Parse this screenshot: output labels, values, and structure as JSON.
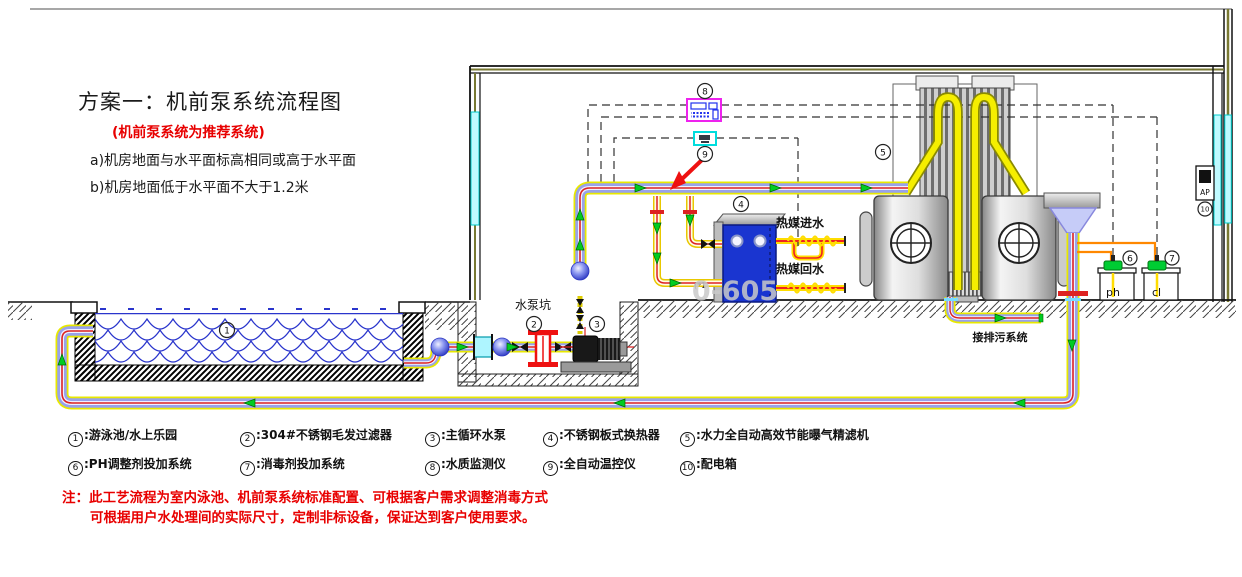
{
  "header": {
    "title": "方案一：机前泵系统流程图",
    "subtitle": "(机前泵系统为推荐系统)",
    "cond_a": "a)机房地面与水平面标高相同或高于水平面",
    "cond_b": "b)机房地面低于水平面不大于1.2米"
  },
  "legend": {
    "items": [
      {
        "num": "1",
        "label": ":游泳池/水上乐园"
      },
      {
        "num": "2",
        "label": ":304#不锈钢毛发过滤器"
      },
      {
        "num": "3",
        "label": ":主循环水泵"
      },
      {
        "num": "4",
        "label": ":不锈钢板式换热器"
      },
      {
        "num": "5",
        "label": ":水力全自动高效节能曝气精滤机"
      },
      {
        "num": "6",
        "label": ":PH调整剂投加系统"
      },
      {
        "num": "7",
        "label": ":消毒剂投加系统"
      },
      {
        "num": "8",
        "label": ":水质监测仪"
      },
      {
        "num": "9",
        "label": ":全自动温控仪"
      },
      {
        "num": "10",
        "label": ":配电箱"
      }
    ]
  },
  "notes": {
    "line1": "注：此工艺流程为室内泳池、机前泵系统标准配置、可根据客户需求调整消毒方式",
    "line2": "可根据用户水处理间的实际尺寸，定制非标设备，保证达到客户使用要求。"
  },
  "diagram": {
    "labels": {
      "pump_pit": "水泵坑",
      "hot_in": "热媒进水",
      "hot_out": "热媒回水",
      "drain": "接排污系统",
      "ph": "ph",
      "cl": "cl",
      "ap": "AP",
      "fitting": "(*1"
    },
    "marks": {
      "m1": "1",
      "m2": "2",
      "m3": "3",
      "m4": "4",
      "m5": "5",
      "m6": "6",
      "m7": "7",
      "m8": "8",
      "m9": "9",
      "m10": "10"
    },
    "watermark": "0-605",
    "colors": {
      "pipe_edge_yellow": "#e8e800",
      "pipe_body_blue": "#98a2ea",
      "pipe_center_red": "#dd2222",
      "water_blue": "#2a35cc",
      "heat_exchanger_blue": "#1a35d0",
      "monitor_magenta": "#ee22ee",
      "controller_cyan": "#00dddd",
      "dosing_orange": "#ff8800",
      "flow_green": "#00cc22",
      "note_red": "#e80000",
      "window_cyan": "#bffaff"
    }
  }
}
